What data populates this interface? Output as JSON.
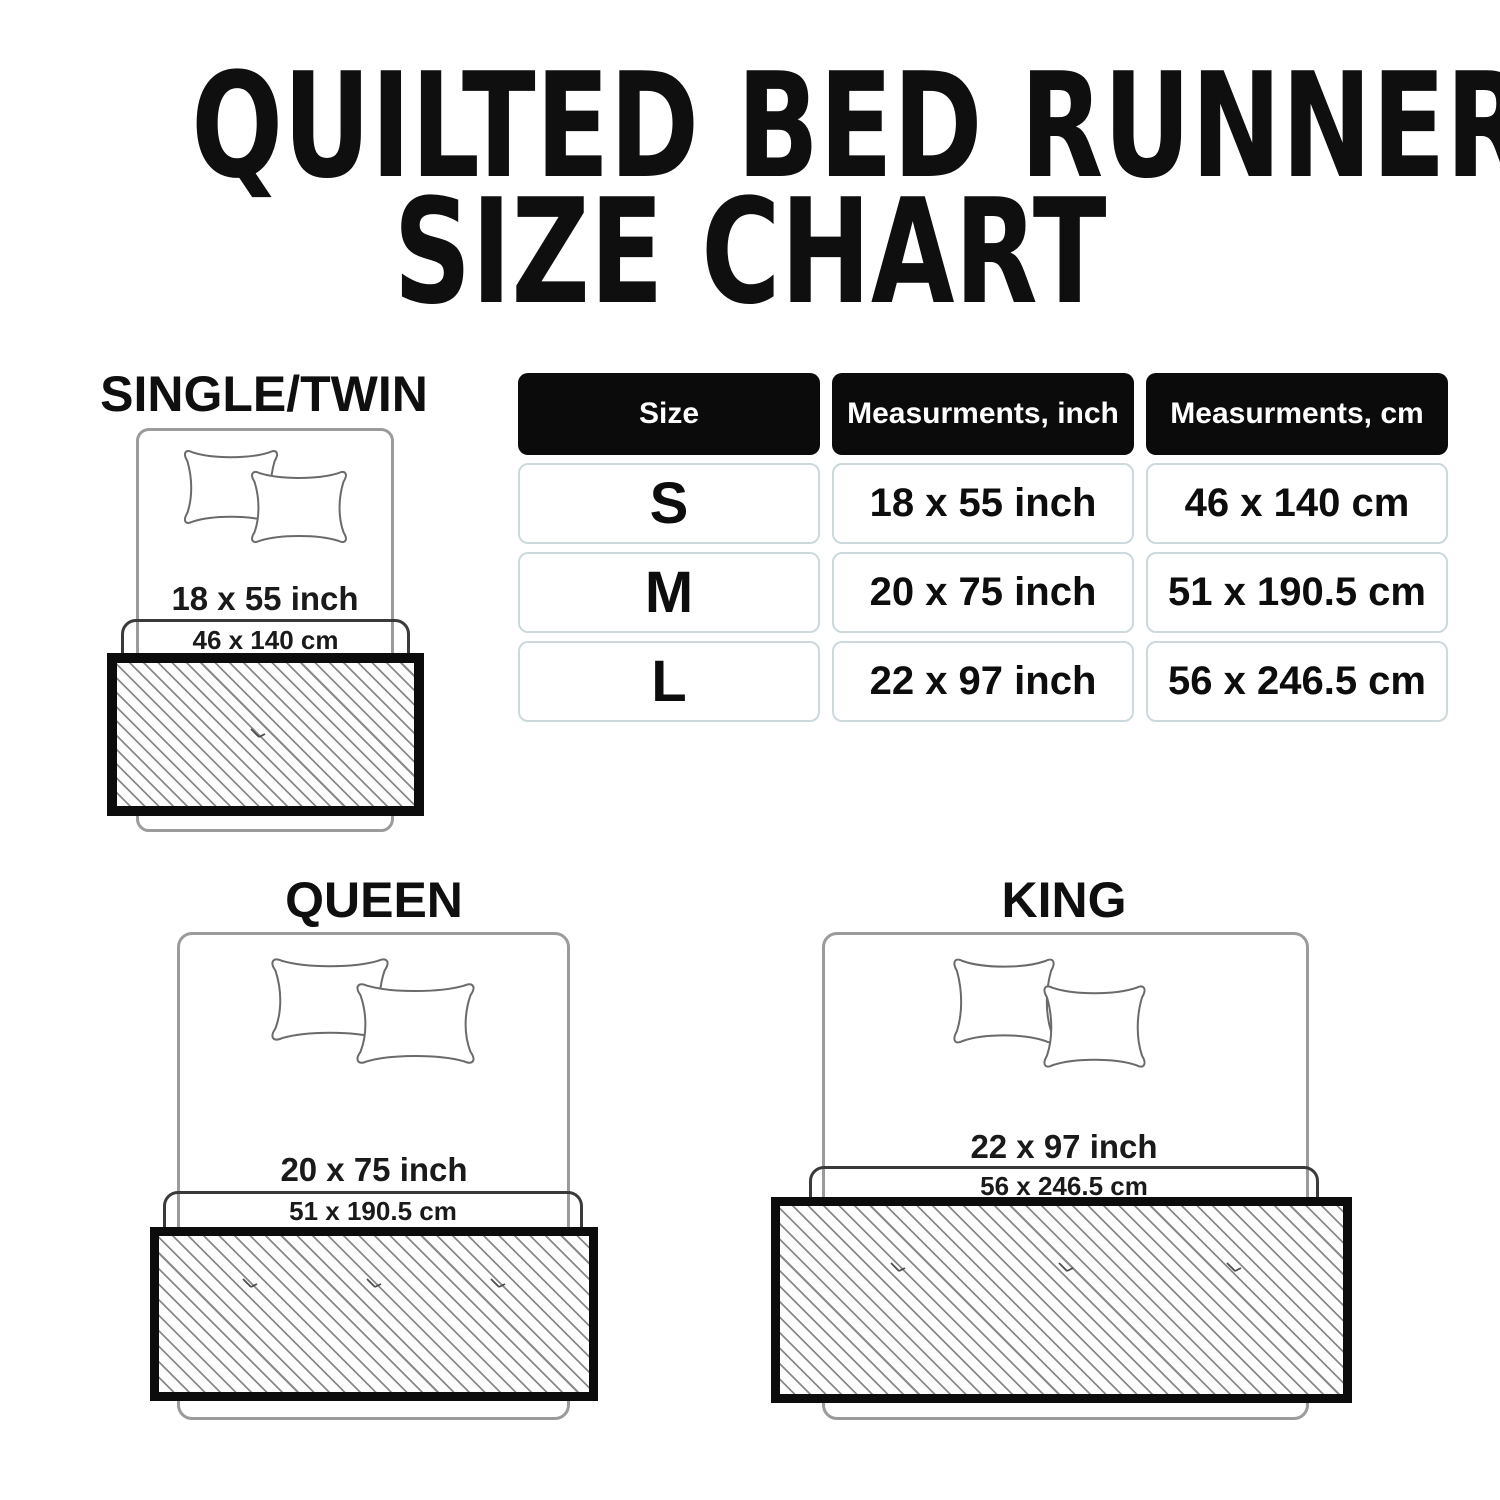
{
  "title": {
    "line1": "QUILTED BED RUNNER",
    "line2": "SIZE CHART"
  },
  "table": {
    "headers": [
      "Size",
      "Measurments, inch",
      "Measurments, cm"
    ],
    "rows": [
      {
        "size": "S",
        "inch": "18 x 55 inch",
        "cm": "46 x 140 cm"
      },
      {
        "size": "M",
        "inch": "20 x 75 inch",
        "cm": "51 x 190.5 cm"
      },
      {
        "size": "L",
        "inch": "22 x 97 inch",
        "cm": "56 x 246.5 cm"
      }
    ]
  },
  "diagrams": [
    {
      "name": "SINGLE/TWIN",
      "inch": "18 x 55 inch",
      "cm": "46 x 140 cm"
    },
    {
      "name": "QUEEN",
      "inch": "20 x 75 inch",
      "cm": "51 x 190.5 cm"
    },
    {
      "name": "KING",
      "inch": "22 x 97 inch",
      "cm": "56 x 246.5 cm"
    }
  ],
  "colors": {
    "header_bg": "#0b0b0b",
    "header_text": "#ffffff",
    "cell_border": "#ccd8dc",
    "runner_border": "#0c0c0c",
    "hatch_line": "#8a8a8a",
    "bed_outline": "#9b9b9b",
    "cover_outline": "#3a3a3a",
    "text": "#0f0f0f"
  },
  "chart_data": {
    "type": "table",
    "title": "QUILTED BED RUNNER SIZE CHART",
    "columns": [
      "Size",
      "Measurments, inch",
      "Measurments, cm"
    ],
    "rows": [
      [
        "S",
        "18 x 55 inch",
        "46 x 140 cm"
      ],
      [
        "M",
        "20 x 75 inch",
        "51 x 190.5 cm"
      ],
      [
        "L",
        "22 x 97 inch",
        "56 x 246.5 cm"
      ]
    ]
  }
}
